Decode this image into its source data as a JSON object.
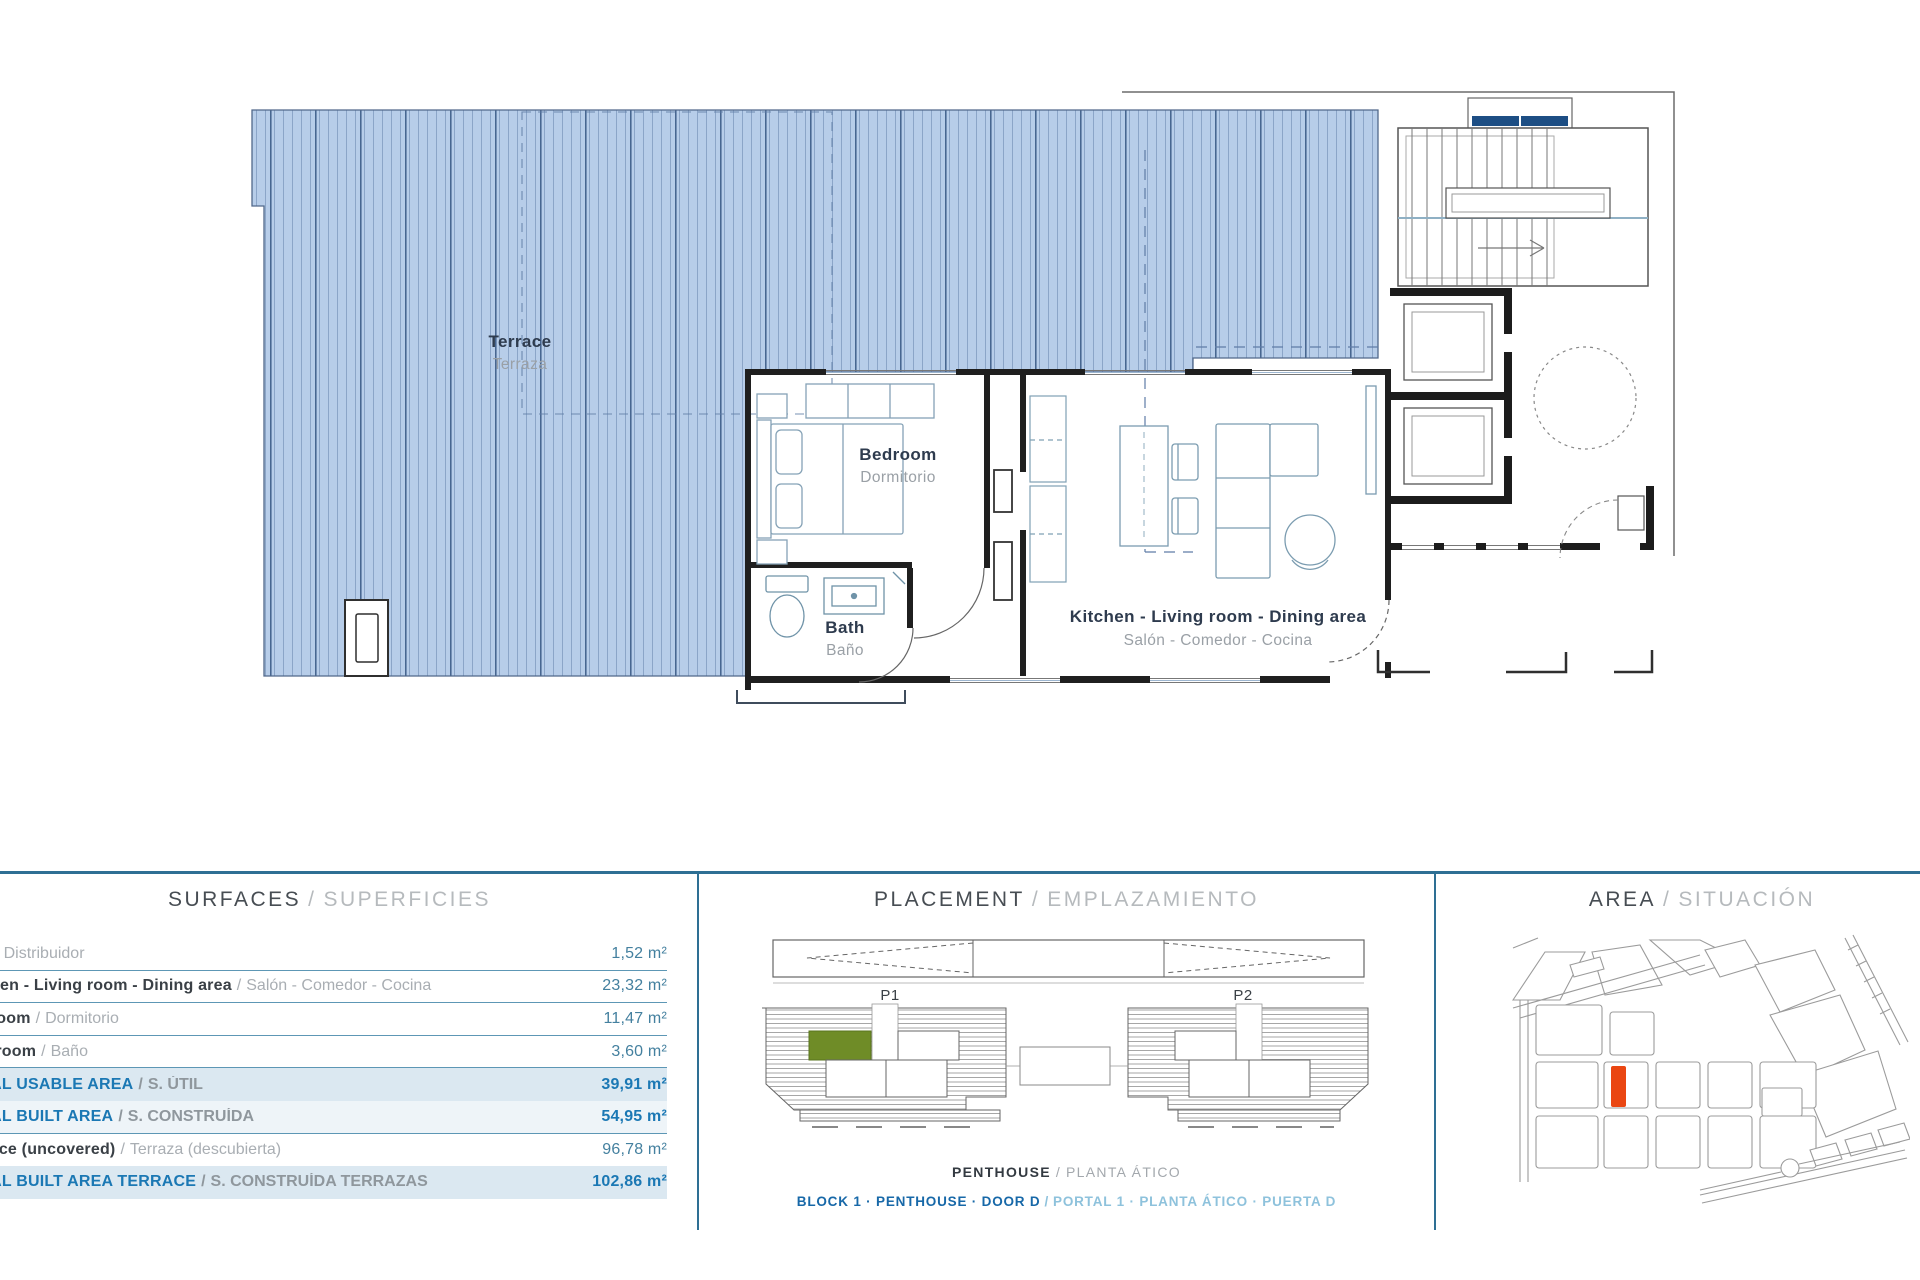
{
  "sep": "/",
  "floor_plan": {
    "rooms": {
      "terrace": {
        "en": "Terrace",
        "es": "Terraza"
      },
      "bedroom": {
        "en": "Bedroom",
        "es": "Dormitorio"
      },
      "bath": {
        "en": "Bath",
        "es": "Baño"
      },
      "kitchen": {
        "en": "Kitchen - Living room - Dining area",
        "es": "Salón - Comedor - Cocina"
      }
    },
    "terrace_fill": "#b7cde9",
    "wall_color": "#1f1f1f"
  },
  "surfaces": {
    "title_en": "SURFACES",
    "title_es": "SUPERFICIES",
    "rows": [
      {
        "en": "Hall",
        "es": "Distribuidor",
        "value": "1,52 m²",
        "total": false
      },
      {
        "en": "Kitchen - Living room - Dining area",
        "es": "Salón - Comedor - Cocina",
        "value": "23,32 m²",
        "total": false
      },
      {
        "en": "Bedroom",
        "es": "Dormitorio",
        "value": "11,47 m²",
        "total": false
      },
      {
        "en": "Bathroom",
        "es": "Baño",
        "value": "3,60 m²",
        "total": false
      },
      {
        "en": "TOTAL USABLE AREA",
        "es": "S. ÚTIL",
        "value": "39,91 m²",
        "total": true
      },
      {
        "en": "TOTAL BUILT AREA",
        "es": "S. CONSTRUÍDA",
        "value": "54,95 m²",
        "total": true
      },
      {
        "en": "Terrace (uncovered)",
        "es": "Terraza (descubierta)",
        "value": "96,78 m²",
        "total": false
      },
      {
        "en": "TOTAL BUILT AREA TERRACE",
        "es": "S. CONSTRUÍDA TERRAZAS",
        "value": "102,86 m²",
        "total": true
      }
    ]
  },
  "placement": {
    "title_en": "PLACEMENT",
    "title_es": "EMPLAZAMIENTO",
    "portal1": "P1",
    "portal2": "P2",
    "floor_en": "PENTHOUSE",
    "floor_es": "PLANTA ÁTICO",
    "unit_en": "BLOCK 1 · PENTHOUSE · DOOR D",
    "unit_es": "PORTAL 1 · PLANTA ÁTICO · PUERTA D",
    "highlight_color": "#6f8c27"
  },
  "area": {
    "title_en": "AREA",
    "title_es": "SITUACIÓN",
    "marker_color": "#ea4612"
  }
}
